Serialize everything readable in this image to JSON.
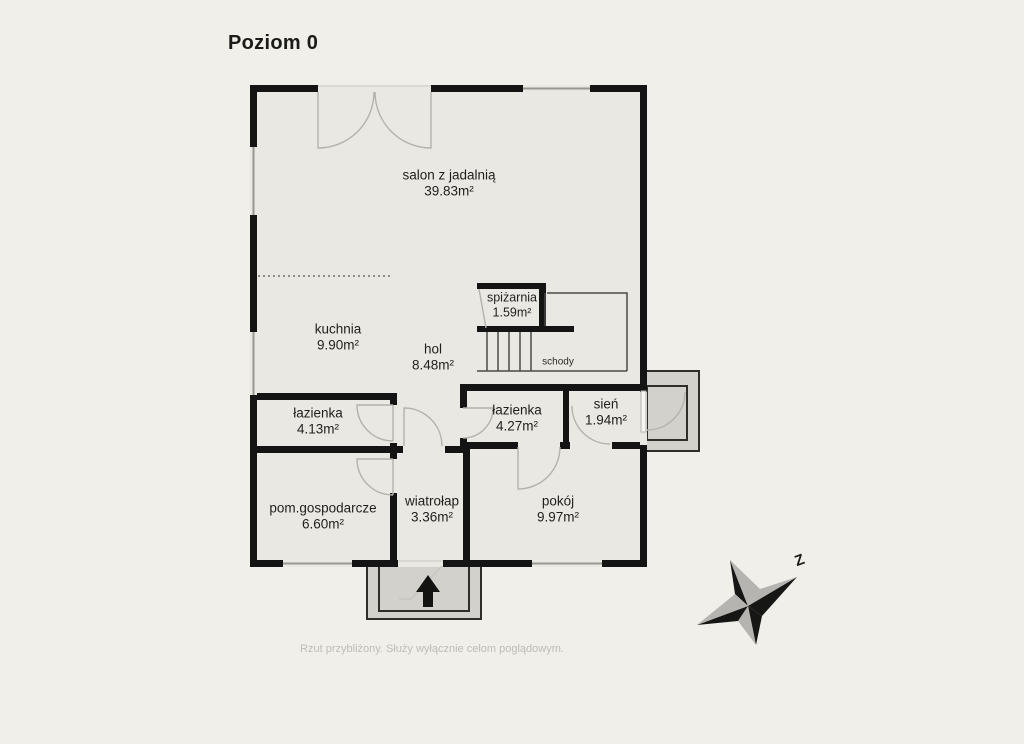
{
  "title": "Poziom 0",
  "footer": "Rzut przybliżony. Służy wyłącznie celom poglądowym.",
  "compass": {
    "label": "Z"
  },
  "stairs": {
    "label": "schody"
  },
  "rooms": [
    {
      "id": "salon",
      "name": "salon z jadalnią",
      "area": "39.83m²"
    },
    {
      "id": "spizarnia",
      "name": "spiżarnia",
      "area": "1.59m²"
    },
    {
      "id": "kuchnia",
      "name": "kuchnia",
      "area": "9.90m²"
    },
    {
      "id": "hol",
      "name": "hol",
      "area": "8.48m²"
    },
    {
      "id": "lazienka-1",
      "name": "łazienka",
      "area": "4.13m²"
    },
    {
      "id": "lazienka-2",
      "name": "łazienka",
      "area": "4.27m²"
    },
    {
      "id": "sien",
      "name": "sień",
      "area": "1.94m²"
    },
    {
      "id": "pom-gosp",
      "name": "pom.gospodarcze",
      "area": "6.60m²"
    },
    {
      "id": "wiatrolap",
      "name": "wiatrołap",
      "area": "3.36m²"
    },
    {
      "id": "pokoj",
      "name": "pokój",
      "area": "9.97m²"
    }
  ],
  "colors": {
    "background": "#f0efea",
    "floor": "#e9e8e3",
    "wall": "#141414",
    "porch": "#d2d1cc",
    "door_line": "#b3b2ad",
    "window_line": "#989792",
    "text": "#1f1f1d",
    "muted_text": "#bdbcb7"
  }
}
